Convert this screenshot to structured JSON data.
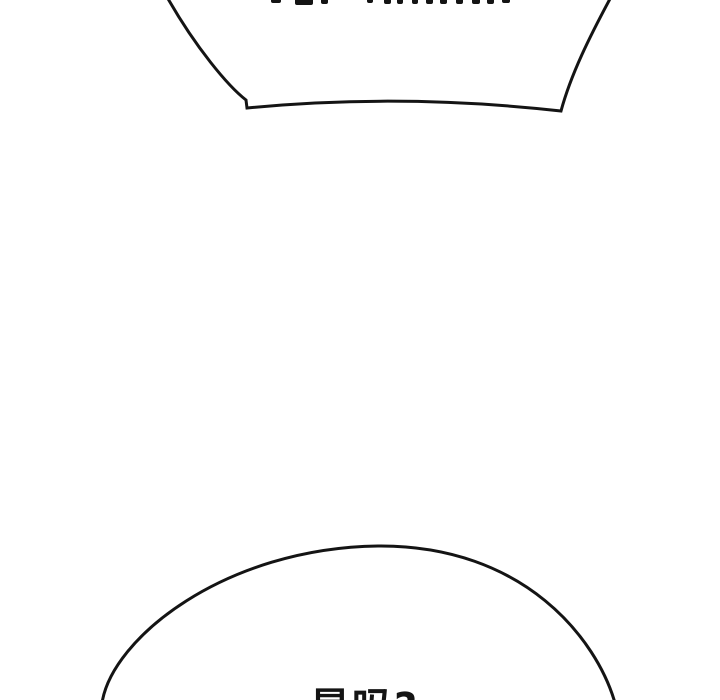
{
  "page": {
    "background_color": "#ffffff",
    "ink_color": "#141414"
  },
  "top_speech_bubble": {
    "note": "bottom portion of a speech bubble; its text is cut off at the top edge of the image",
    "cutoff_text_fragments": [
      {
        "x": 271,
        "w": 10,
        "h": 3
      },
      {
        "x": 295,
        "w": 18,
        "h": 5
      },
      {
        "x": 321,
        "w": 7,
        "h": 4
      },
      {
        "x": 367,
        "w": 6,
        "h": 3
      },
      {
        "x": 384,
        "w": 7,
        "h": 4
      },
      {
        "x": 397,
        "w": 6,
        "h": 4
      },
      {
        "x": 412,
        "w": 6,
        "h": 4
      },
      {
        "x": 426,
        "w": 7,
        "h": 4
      },
      {
        "x": 440,
        "w": 7,
        "h": 4
      },
      {
        "x": 456,
        "w": 7,
        "h": 4
      },
      {
        "x": 472,
        "w": 8,
        "h": 4
      },
      {
        "x": 487,
        "w": 7,
        "h": 4
      },
      {
        "x": 502,
        "w": 8,
        "h": 3
      }
    ]
  },
  "bottom_speech_bubble": {
    "text": "是吗?"
  }
}
